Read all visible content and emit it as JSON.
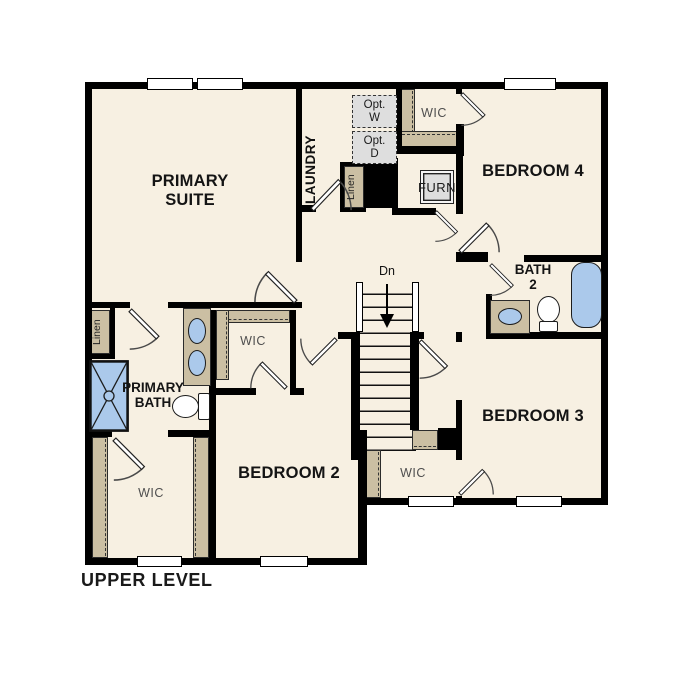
{
  "plan": {
    "title": "UPPER LEVEL",
    "rooms": {
      "primary_suite": "PRIMARY\nSUITE",
      "laundry": "LAUNDRY",
      "bedroom2": "BEDROOM 2",
      "bedroom3": "BEDROOM 3",
      "bedroom4": "BEDROOM 4",
      "bath2": "BATH\n2",
      "primary_bath": "PRIMARY\nBATH",
      "wic_top": "WIC",
      "wic_middle": "WIC",
      "wic_left": "WIC",
      "wic_understairs": "WIC",
      "linen_top": "Linen",
      "linen_left": "Linen",
      "furnace": "FURN",
      "opt_washer": "Opt.\nW",
      "opt_dryer": "Opt.\nD",
      "stairs_down": "Dn"
    },
    "colors": {
      "wall": "#000000",
      "room_fill": "#f7f0e2",
      "shelf": "#cbbfa3",
      "fixture_blue": "#abc9eb",
      "appliance_gray": "#dedede",
      "outline": "#2b2b2b",
      "label": "#141414",
      "label_muted": "#4f4f4f"
    }
  }
}
